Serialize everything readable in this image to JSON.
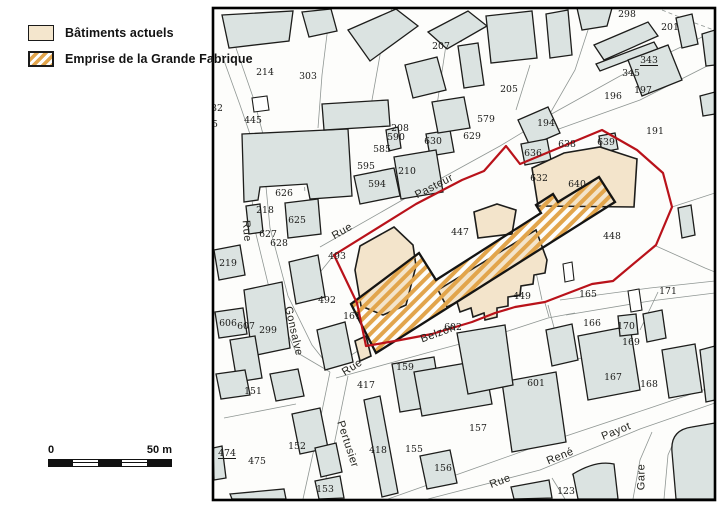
{
  "legend": {
    "items": [
      {
        "label": "Bâtiments actuels",
        "swatch": "beige"
      },
      {
        "label": "Emprise de la Grande Fabrique",
        "swatch": "hatched"
      }
    ]
  },
  "scale_bar": {
    "start_label": "0",
    "end_label": "50 m",
    "segments": 5
  },
  "colors": {
    "building_fill": "#dbe3e1",
    "building_stroke": "#1d1d1b",
    "current_building_fill": "#f3e4cb",
    "hatch_stripe": "#e2a54c",
    "boundary": "#b9121a",
    "parcel_line": "#8f9693",
    "label_color": "#1a1a18",
    "street_label_color": "#24241f"
  },
  "map": {
    "frame": {
      "x": 213,
      "y": 8,
      "w": 502,
      "h": 492
    },
    "parcel_lines": [
      "M320,247 L420,190 L500,146 L548,117 L575,70 L588,30 L590,8",
      "M304,292 L334,255",
      "M247,148 L255,230 L272,300 L296,352",
      "M262,145 L270,228 L288,296 L312,345 L330,368",
      "M222,55 L240,105 L252,140",
      "M236,48 L254,100 L264,138",
      "M330,10 L322,75 L318,128",
      "M392,8 L380,55 L372,100 L370,128",
      "M446,45 L440,85 L436,112",
      "M530,65 L516,110",
      "M548,116 L620,76 L700,38 L715,30",
      "M556,130 L640,100 L715,62",
      "M336,378 L430,352 L505,332 L548,318 L575,313",
      "M560,300 L650,288 L715,281",
      "M566,315 L650,301 L715,293",
      "M330,372 L316,440 L303,499",
      "M348,376 L334,445 L321,499",
      "M388,499 L470,470 L560,438 L650,408 L715,386",
      "M428,499 L540,470 L640,429 L715,403",
      "M633,499 L640,460 L652,432",
      "M664,499 L668,455 L678,432",
      "M548,305 L556,335 L562,362",
      "M562,362 L612,352",
      "M528,235 L542,300",
      "M640,330 L658,292",
      "M552,478 L565,499",
      "M572,474 L584,497",
      "M224,418 L296,404",
      "M545,303 L549,317",
      "M672,207 L715,193",
      "M656,246 L705,268 L715,272",
      "M330,368 L366,346",
      "M296,352 L330,372"
    ],
    "dashed_lines": [
      "M254,162 L342,157",
      "M302,138 L305,194",
      "M662,10 L692,22 L714,30",
      "M330,115 L384,110",
      "M676,450 L714,444"
    ],
    "buildings": [
      "M222,15 L293,11 L289,41 L229,48 Z",
      "M302,12 L331,9 L337,31 L309,37 Z",
      "M348,30 L396,9 L418,26 L370,61 Z",
      "M443,26 L459,24 L461,41 L445,43 Z",
      "M428,32 L468,11 L487,26 L447,49 Z",
      "M405,65 L437,57 L446,90 L413,98 Z",
      "M458,46 L478,43 L484,85 L464,88 Z",
      "M486,16 L532,11 L537,58 L491,63 Z",
      "M546,14 L568,10 L572,55 L550,58 Z",
      "M577,8 L612,8 L607,26 L582,30 Z",
      "M594,45 L648,22 L658,36 L604,60 Z",
      "M596,64 L654,42 L658,49 L600,71 Z",
      "M676,18 L692,14 L698,44 L682,48 Z",
      "M702,34 L715,30 L715,65 L706,66 Z",
      "M628,60 L668,45 L682,80 L642,96 Z",
      "M518,120 L548,107 L560,133 L530,146 Z",
      "M700,96 L715,92 L715,114 L703,116 Z",
      "M242,134 L348,129 L352,196 L310,199 L307,184 L260,187 L258,200 L244,202 Z",
      "M322,104 L388,100 L390,126 L324,130 Z",
      "M285,203 L318,199 L321,234 L288,238 Z",
      "M246,206 L260,204 L263,232 L249,234 Z",
      "M426,134 L450,130 L454,152 L430,156 Z",
      "M386,130 L398,127 L401,148 L389,151 Z",
      "M432,102 L464,97 L470,128 L438,133 Z",
      "M394,157 L436,150 L443,192 L401,199 Z",
      "M354,176 L394,168 L400,196 L360,204 Z",
      "M521,144 L547,139 L551,160 L525,165 Z",
      "M599,136 L615,133 L618,149 L602,152 Z",
      "M214,250 L240,245 L245,275 L219,280 Z",
      "M244,290 L282,282 L290,348 L252,356 Z",
      "M215,312 L243,308 L247,334 L219,338 Z",
      "M230,340 L255,336 L262,378 L237,382 Z",
      "M289,262 L318,255 L325,297 L296,304 Z",
      "M317,330 L345,322 L353,362 L325,370 Z",
      "M216,374 L245,370 L250,395 L221,399 Z",
      "M270,374 L298,369 L304,396 L276,401 Z",
      "M292,414 L320,408 L328,448 L300,454 Z",
      "M315,448 L336,443 L342,472 L321,477 Z",
      "M213,448 L222,446 L226,478 L214,480 Z",
      "M315,481 L340,476 L344,498 L319,499 Z",
      "M230,494 L284,489 L286,499 L232,499 Z",
      "M392,364 L434,357 L442,405 L400,412 Z",
      "M364,400 L380,396 L398,493 L382,497 Z",
      "M414,372 L484,360 L492,404 L422,416 Z",
      "M502,382 L556,372 L566,442 L512,452 Z",
      "M420,456 L450,450 L457,483 L427,489 Z",
      "M457,333 L505,325 L513,385 L468,394 Z",
      "M578,336 L630,326 L640,390 L588,400 Z",
      "M618,316 L636,314 L638,334 L620,336 Z",
      "M643,314 L662,310 L666,338 L647,342 Z",
      "M662,350 L695,344 L702,392 L669,398 Z",
      "M700,350 L715,346 L715,400 L706,402 Z",
      "M546,330 L572,324 L578,360 L552,366 Z",
      "M678,208 L691,205 L695,235 L682,238 Z",
      "M573,474 Q596,460 614,464 L618,499 L578,499 Z",
      "M676,499 L672,452 Q670,430 692,427 L715,423 L715,499 Z",
      "M511,487 L549,480 L552,498 L514,499 Z"
    ],
    "white_buildings": [
      "M252,98 L267,96 L269,110 L254,112 Z",
      "M563,264 L572,262 L574,280 L565,282 Z",
      "M628,291 L639,289 L642,310 L631,312 Z"
    ],
    "current_buildings": [
      "M360,246 L394,227 L413,245 L416,266 L406,305 L383,315 L361,306 L355,270 Z",
      "M474,212 L497,204 L516,210 L512,234 L478,238 Z",
      "M438,290 L447,307 L457,302 L460,312 L471,308 L473,317 L484,313 L485,320 L497,317 L497,308 L508,306 L508,297 L520,295 L521,286 L533,284 L534,275 L545,273 L547,260 L536,230 Z",
      "M532,168 L564,153 L600,147 L637,159 L634,207 L538,206 Z",
      "M355,341 L366,336 L371,356 L360,361 Z"
    ],
    "fabrique_outline": "M376,353 L615,202 L599,177 L558,202 L553,194 L536,205 L541,213 L436,280 L419,253 L351,304 Z",
    "boundary": "M334,255 L416,204 L462,180 L484,171 L506,146 L520,164 L602,130 L637,150 L663,173 L672,207 L656,245 L613,281 L592,284 L545,302 L515,307 L495,313 L472,322 L432,334 L395,341 L366,346 L357,303 Z",
    "parcel_labels": [
      [
        "214",
        265,
        72
      ],
      [
        "303",
        308,
        76
      ],
      [
        "207",
        441,
        46
      ],
      [
        "298",
        627,
        14
      ],
      [
        "205",
        509,
        89
      ],
      [
        "201",
        670,
        27
      ],
      [
        "343",
        649,
        60,
        1
      ],
      [
        "345",
        631,
        73
      ],
      [
        "196",
        613,
        96
      ],
      [
        "197",
        643,
        90
      ],
      [
        "191",
        655,
        131
      ],
      [
        "194",
        546,
        123
      ],
      [
        "445",
        253,
        120
      ],
      [
        "208",
        400,
        128
      ],
      [
        "590",
        396,
        137
      ],
      [
        "630",
        433,
        141
      ],
      [
        "629",
        472,
        136
      ],
      [
        "579",
        486,
        119
      ],
      [
        "585",
        382,
        149
      ],
      [
        "595",
        366,
        166
      ],
      [
        "210",
        407,
        171
      ],
      [
        "594",
        377,
        184
      ],
      [
        "626",
        284,
        193
      ],
      [
        "218",
        265,
        210
      ],
      [
        "625",
        297,
        220
      ],
      [
        "627",
        268,
        234
      ],
      [
        "628",
        279,
        243
      ],
      [
        "636",
        533,
        153
      ],
      [
        "638",
        567,
        144
      ],
      [
        "639",
        606,
        142
      ],
      [
        "632",
        539,
        178
      ],
      [
        "640",
        577,
        184
      ],
      [
        "447",
        460,
        232
      ],
      [
        "448",
        612,
        236
      ],
      [
        "449",
        522,
        296
      ],
      [
        "219",
        228,
        263
      ],
      [
        "493",
        337,
        256
      ],
      [
        "492",
        327,
        300
      ],
      [
        "161",
        352,
        316
      ],
      [
        "606",
        228,
        323
      ],
      [
        "607",
        246,
        326
      ],
      [
        "299",
        268,
        330
      ],
      [
        "602",
        453,
        327
      ],
      [
        "165",
        588,
        294
      ],
      [
        "166",
        592,
        323
      ],
      [
        "171",
        668,
        291
      ],
      [
        "170",
        626,
        326
      ],
      [
        "169",
        631,
        342
      ],
      [
        "167",
        613,
        377
      ],
      [
        "168",
        649,
        384
      ],
      [
        "151",
        253,
        391
      ],
      [
        "474",
        227,
        453,
        1
      ],
      [
        "475",
        257,
        461
      ],
      [
        "152",
        297,
        446
      ],
      [
        "153",
        325,
        489
      ],
      [
        "417",
        366,
        385
      ],
      [
        "418",
        378,
        450
      ],
      [
        "159",
        405,
        367
      ],
      [
        "155",
        414,
        449
      ],
      [
        "156",
        443,
        468
      ],
      [
        "157",
        478,
        428
      ],
      [
        "601",
        536,
        383
      ],
      [
        "123",
        566,
        491
      ],
      [
        "32",
        217,
        108
      ],
      [
        "5",
        215,
        124
      ]
    ],
    "street_labels": [
      [
        "Rue",
        247,
        231,
        85
      ],
      [
        "Gonsalve",
        294,
        331,
        77
      ],
      [
        "Rue",
        342,
        231,
        -30
      ],
      [
        "Pasteur",
        434,
        186,
        -27
      ],
      [
        "Rue",
        352,
        367,
        -32
      ],
      [
        "Belzon",
        438,
        333,
        -20
      ],
      [
        "Pertusier",
        348,
        444,
        72
      ],
      [
        "Rue",
        500,
        481,
        -21
      ],
      [
        "René",
        560,
        456,
        -22
      ],
      [
        "Payot",
        616,
        431,
        -22
      ],
      [
        "Gare",
        641,
        477,
        -90
      ]
    ]
  }
}
